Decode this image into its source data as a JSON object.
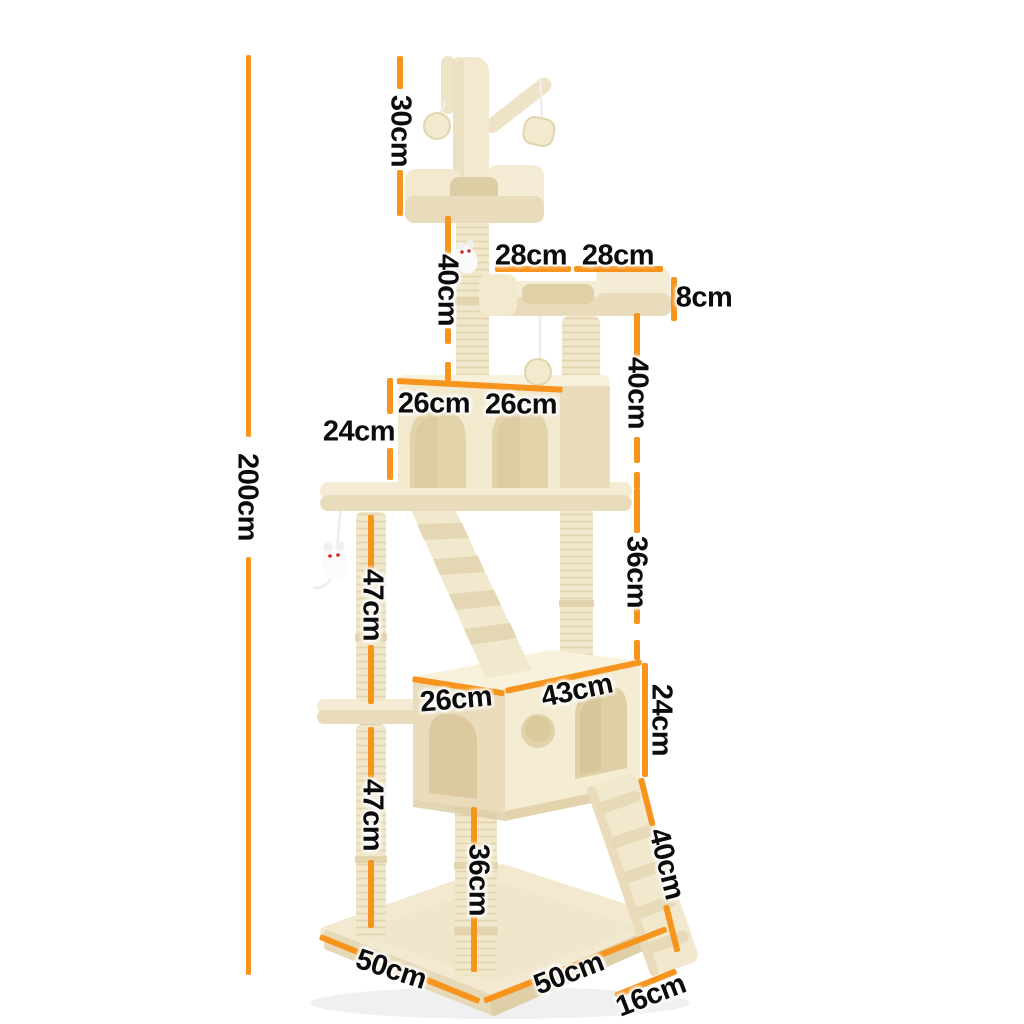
{
  "accent_color": "#f7941d",
  "background_color": "#ffffff",
  "illustration": {
    "subject_icon": "cat-tree-illustration"
  },
  "dimensions": {
    "total_height": {
      "label": "200cm"
    },
    "top_section": {
      "label": "30cm"
    },
    "upper_post": {
      "label": "40cm"
    },
    "top_perch_left": {
      "label": "28cm"
    },
    "top_perch_right": {
      "label": "28cm"
    },
    "perch_thickness": {
      "label": "8cm"
    },
    "perch_post": {
      "label": "40cm"
    },
    "condo_top_left": {
      "label": "26cm"
    },
    "condo_top_right": {
      "label": "26cm"
    },
    "upper_condo_height": {
      "label": "24cm"
    },
    "mid_post": {
      "label": "36cm"
    },
    "left_post_upper": {
      "label": "47cm"
    },
    "lower_condo_depth": {
      "label": "26cm"
    },
    "lower_condo_width": {
      "label": "43cm"
    },
    "lower_condo_height": {
      "label": "24cm"
    },
    "left_post_lower": {
      "label": "47cm"
    },
    "ladder_length": {
      "label": "40cm"
    },
    "bottom_post": {
      "label": "36cm"
    },
    "base_depth": {
      "label": "50cm"
    },
    "base_width": {
      "label": "50cm"
    },
    "ladder_width": {
      "label": "16cm"
    }
  }
}
